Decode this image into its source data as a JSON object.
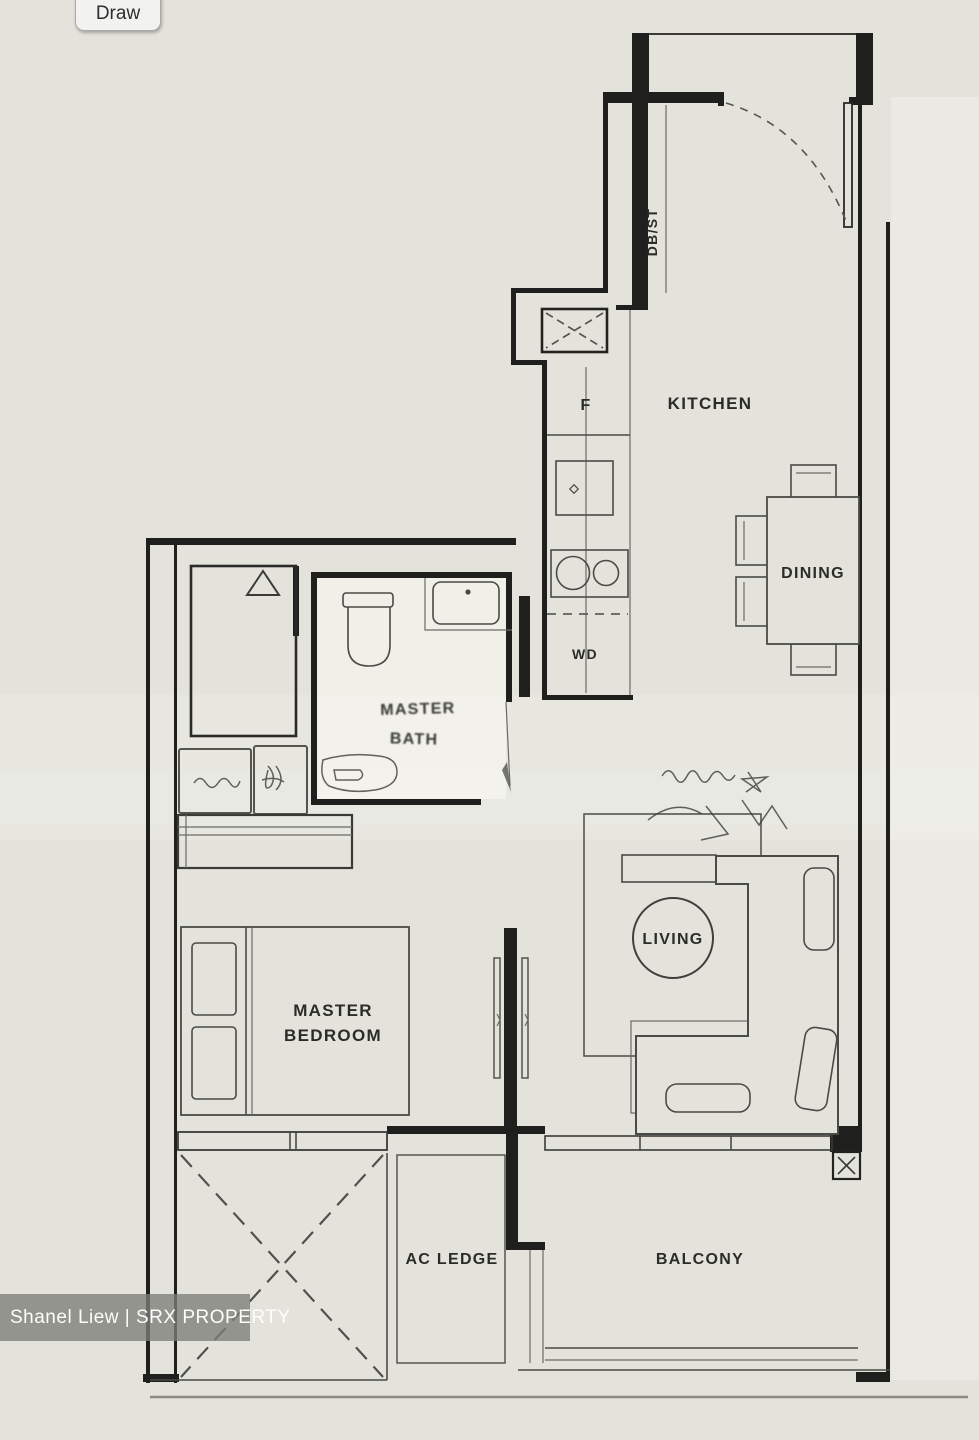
{
  "toolbar": {
    "draw_label": "Draw"
  },
  "watermark": {
    "text": "Shanel Liew | SRX PROPERTY"
  },
  "floorplan": {
    "labels": {
      "kitchen": "KITCHEN",
      "dining": "DINING",
      "living": "LIVING",
      "master_bedroom_1": "MASTER",
      "master_bedroom_2": "BEDROOM",
      "master_bath_1": "MASTER",
      "master_bath_2": "BATH",
      "ac_ledge": "AC LEDGE",
      "balcony": "BALCONY",
      "db_st": "DB/ST",
      "fridge": "F",
      "washer_dryer": "WD"
    },
    "colors": {
      "canvas": "#e4e3db",
      "wall": "#1f1f1d",
      "furniture_line": "#4a4a46",
      "bath_floor": "#f0efe8",
      "watermark_bar": "rgba(125,125,120,0.78)",
      "watermark_text": "#fdfdfb"
    }
  }
}
